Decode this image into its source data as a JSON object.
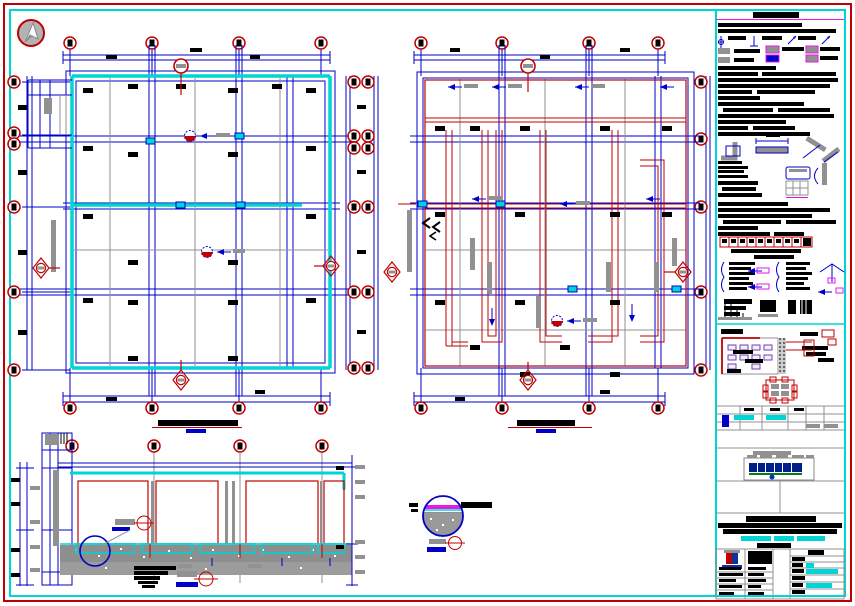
{
  "meta": {
    "label": "Structural CAD drawing sheet: two framing floor plans, longitudinal section, slab detail circle and side notes panel with title block",
    "sheet_style": "white sheet, red outer frame, cyan inner frame"
  },
  "colors": {
    "red": "#c00000",
    "red2": "#e00000",
    "blue": "#0000c8",
    "navy": "#001f8c",
    "cyan": "#00d4d4",
    "gray": "#919191",
    "lgray": "#cccccc",
    "magenta": "#e518e5",
    "violet": "#7040b0",
    "green": "#0a7a0a",
    "slab": "#8e8e8e"
  },
  "views": {
    "plan_left": {
      "name": "floor-plan-left",
      "grid_bubbles_top": 4,
      "grid_bubbles_bottom": 4,
      "grid_bubbles_left": 6,
      "wall_color": "cyan"
    },
    "plan_right": {
      "name": "floor-plan-right",
      "grid_bubbles_top": 4,
      "grid_bubbles_bottom": 4,
      "wall_color": "red"
    },
    "section": {
      "name": "longitudinal-section",
      "grid_bubbles": 4
    },
    "detail": {
      "name": "slab-detail-circle"
    }
  },
  "legend": {
    "swatches": [
      {
        "name": "gray-hatch",
        "fill": "#919191",
        "border": "none"
      },
      {
        "name": "gray-hatch-magenta-border",
        "fill": "#919191",
        "border": "#e518e5"
      },
      {
        "name": "blue-element-magenta-border",
        "fill": "#0000c8",
        "border": "#e518e5"
      }
    ]
  },
  "panel": {
    "sections": [
      "general-notes",
      "detail-sketches",
      "beam-schedule-strip",
      "key-plan",
      "revision-table",
      "logo",
      "project-title",
      "title-block"
    ],
    "highlight_color": "#00d4d4"
  }
}
